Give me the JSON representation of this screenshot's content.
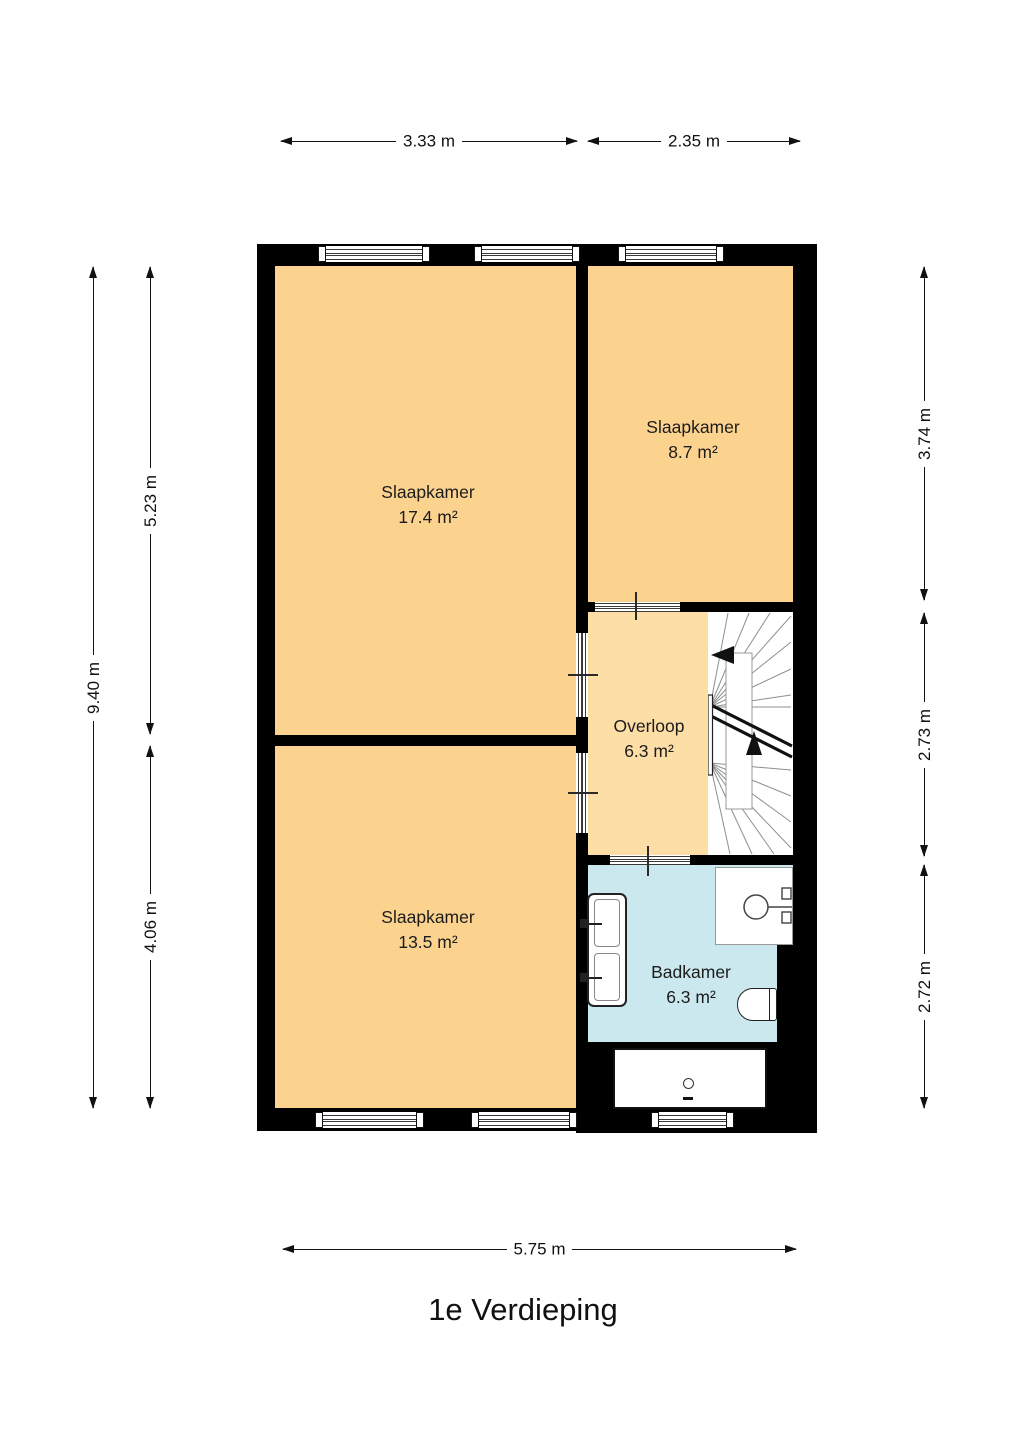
{
  "title": "1e Verdieping",
  "rooms": {
    "bedroom1": {
      "name": "Slaapkamer",
      "area": "17.4 m²"
    },
    "bedroom2": {
      "name": "Slaapkamer",
      "area": "8.7 m²"
    },
    "bedroom3": {
      "name": "Slaapkamer",
      "area": "13.5 m²"
    },
    "landing": {
      "name": "Overloop",
      "area": "6.3 m²"
    },
    "bathroom": {
      "name": "Badkamer",
      "area": "6.3 m²"
    }
  },
  "dimensions": {
    "top_left_width": "3.33 m",
    "top_right_width": "2.35 m",
    "bottom_width": "5.75 m",
    "left_total_height": "9.40 m",
    "left_upper_height": "5.23 m",
    "left_lower_height": "4.06 m",
    "right_upper_height": "3.74 m",
    "right_middle_height": "2.73 m",
    "right_lower_height": "2.72 m"
  },
  "colors": {
    "wall": "#000000",
    "bedroom_fill": "#FBD28E",
    "landing_fill": "#FCDEA6",
    "bathroom_fill": "#CAE8EE",
    "background": "#FFFFFF",
    "dimension_line": "#111111"
  }
}
